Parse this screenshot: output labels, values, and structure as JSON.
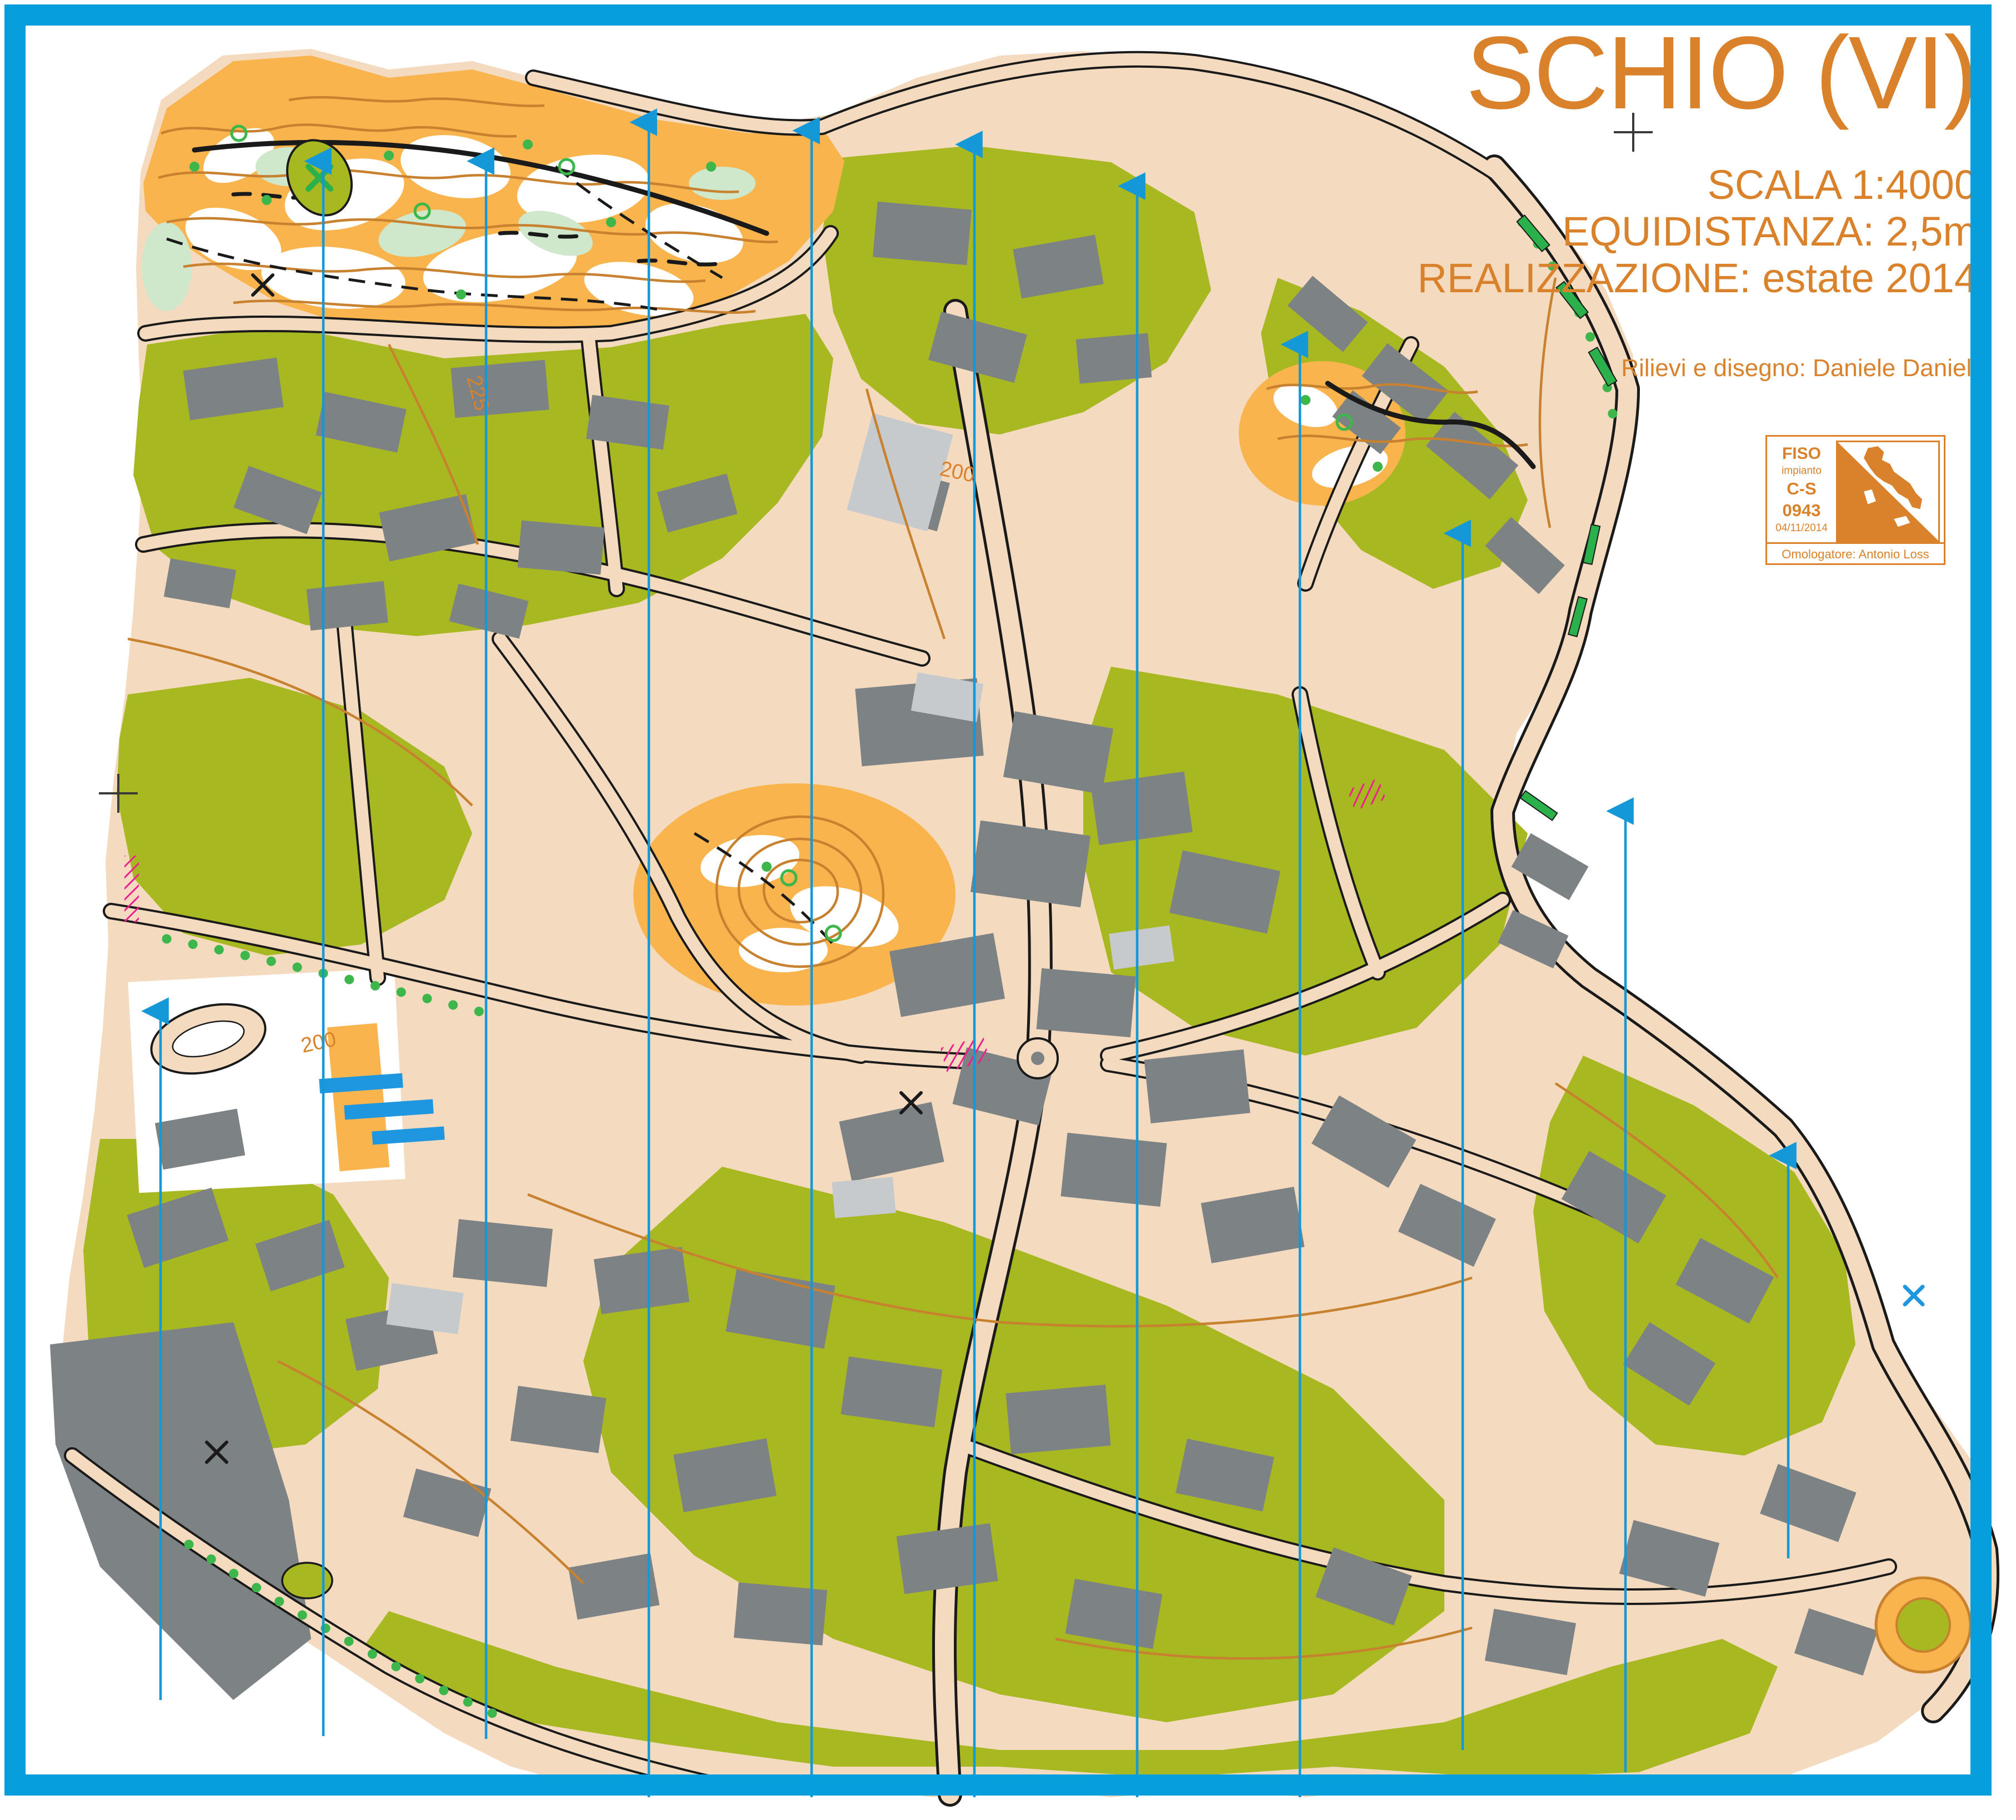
{
  "page": {
    "background": "#ffffff",
    "frame_color": "#069edd"
  },
  "header": {
    "title": "SCHIO (VI)",
    "scale": "SCALA 1:4000",
    "equidistance": "EQUIDISTANZA: 2,5m",
    "realization": "REALIZZAZIONE: estate 2014",
    "credits": "Rilievi e disegno: Daniele Danieli"
  },
  "logo": {
    "federation": "FISO",
    "type_label": "impianto",
    "category": "C-S",
    "number": "0943",
    "date": "04/11/2014",
    "homologator": "Omologatore: Antonio Loss"
  },
  "map": {
    "name": "Sprint orienteering map of Schio town centre",
    "contour_labels": [
      {
        "text": "200"
      },
      {
        "text": "225"
      },
      {
        "text": "200"
      }
    ],
    "palette": {
      "paved_beige": "#f4dbc0",
      "olive_green": "#a8b821",
      "rough_open_orange": "#f9b44d",
      "building_gray": "#7d8284",
      "canopy_gray": "#c6cacd",
      "forest_white": "#ffffff",
      "contour_brown": "#c8812f",
      "water_blue": "#1f97e0",
      "tree_green": "#3db64b",
      "hedge_green": "#2ab14b",
      "meridian_blue": "#1598d8",
      "out_of_bounds_magenta": "#ec1f8f",
      "outline_black": "#1a1a1a"
    }
  }
}
